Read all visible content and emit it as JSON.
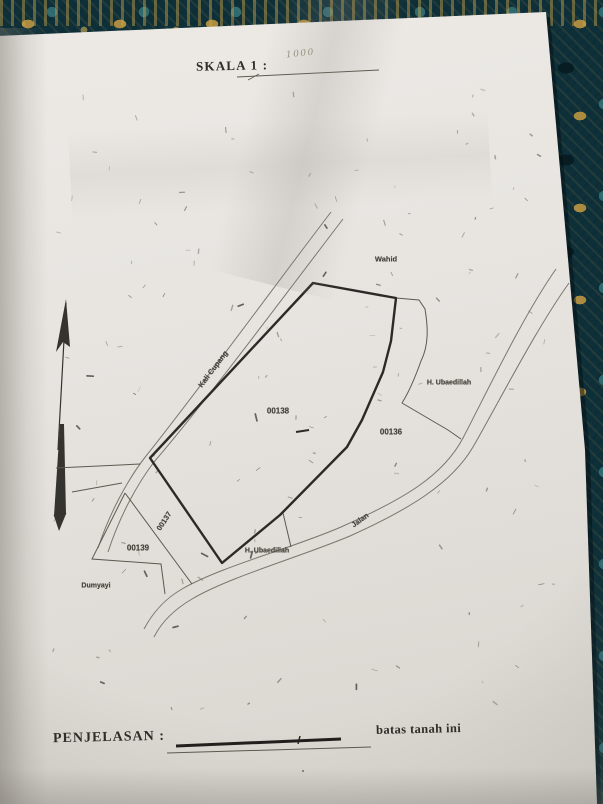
{
  "document": {
    "scale_label": "SKALA 1 :",
    "scale_value_handwritten": "1000",
    "legend_label": "PENJELASAN :",
    "legend_note": "batas tanah ini"
  },
  "map": {
    "labels": {
      "neighbor_top": "Wahid",
      "river_road": "Kali Cupang",
      "parcel_main": "00138",
      "parcel_east": "00136",
      "parcel_strip": "00137",
      "parcel_southwest": "00139",
      "neighbor_east": "H. Ubaedillah",
      "neighbor_south": "H. Ubaedillah",
      "neighbor_southwest": "Dumyayi",
      "road": "Jalan"
    }
  },
  "colors": {
    "paper": "#e8e5e1",
    "fabric_teal": "#0f3039",
    "fabric_gold": "#c69b42",
    "ink_thick": "#2c2a27",
    "ink_thin": "#5d594f",
    "road_line": "#7b766c"
  }
}
